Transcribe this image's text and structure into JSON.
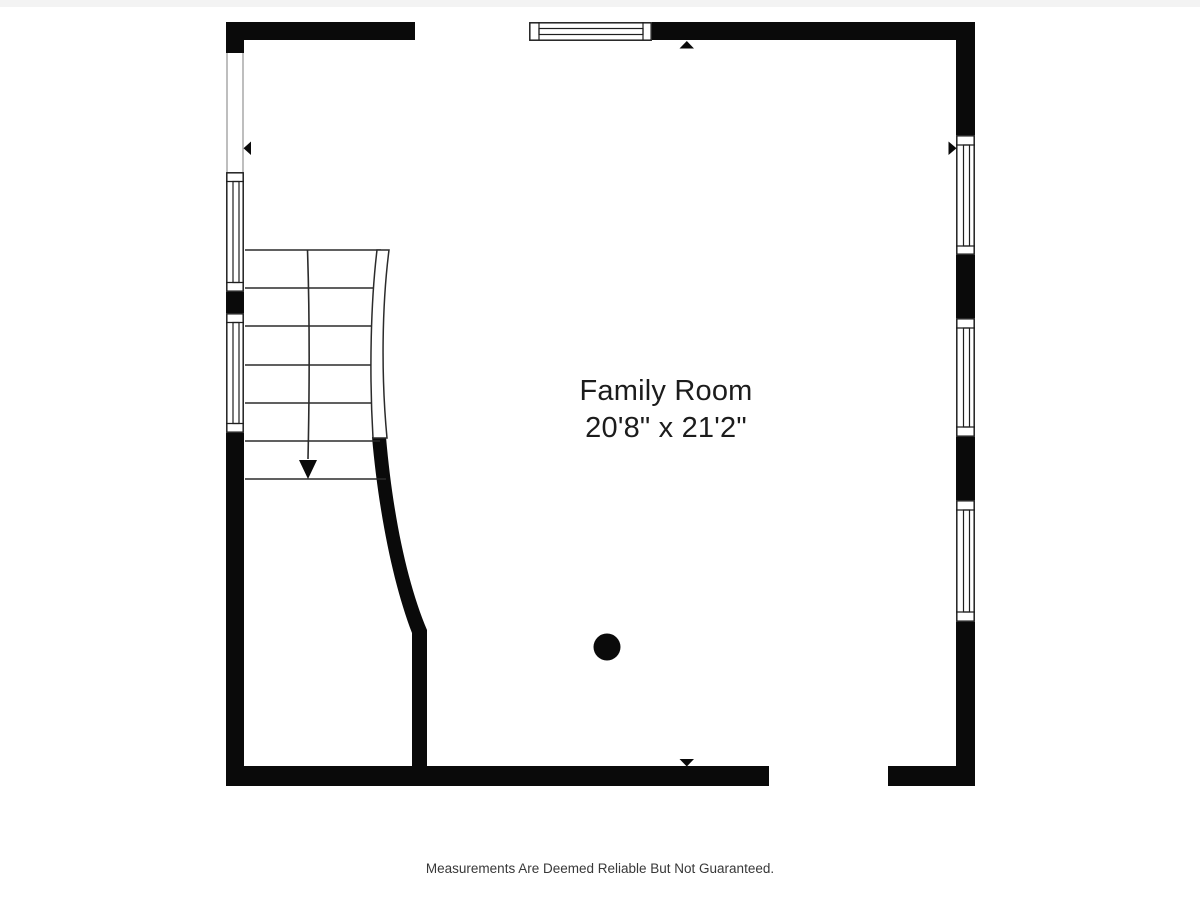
{
  "colors": {
    "background": "#ffffff",
    "top-strip": "#f3f3f3",
    "wall": "#0a0a0a",
    "stair-line": "#2b2b2b",
    "window-line": "#1f1f1f",
    "opening-line": "#9b9b9b",
    "room-text": "#1c1c1c",
    "footer-text": "#383838"
  },
  "room": {
    "name": "Family Room",
    "dimensions": "20'8\" x 21'2\""
  },
  "footer": {
    "disclaimer": "Measurements Are Deemed Reliable But Not Guaranteed."
  }
}
